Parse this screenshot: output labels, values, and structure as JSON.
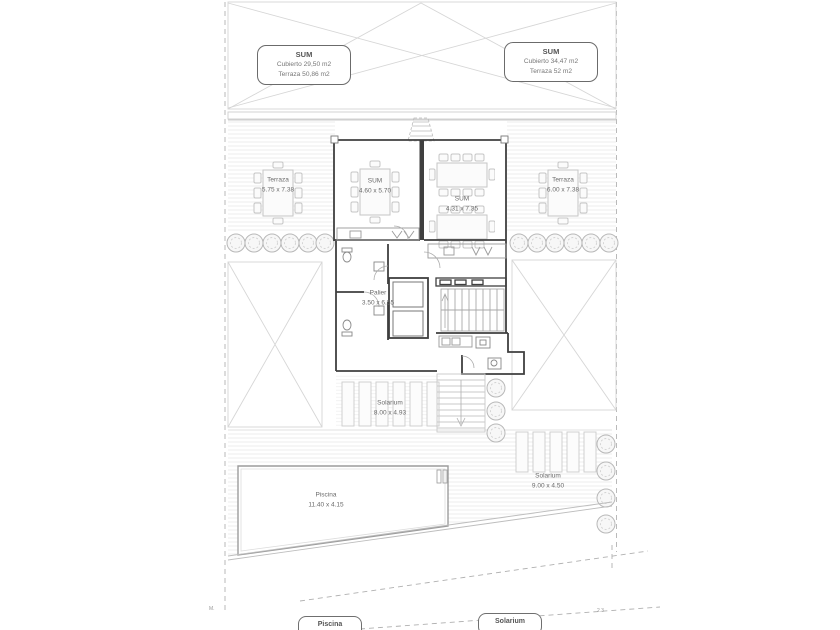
{
  "plan": {
    "callouts": {
      "left": {
        "title": "SUM",
        "line1": "Cubierto 29,50 m2",
        "line2": "Terraza 50,86 m2"
      },
      "right": {
        "title": "SUM",
        "line1": "Cubierto 34,47 m2",
        "line2": "Terraza 52 m2"
      }
    },
    "rooms": {
      "terraza_left": {
        "name": "Terraza",
        "dims": "5.75 x 7.38"
      },
      "sum_left": {
        "name": "SUM",
        "dims": "4.60 x 5.70"
      },
      "sum_right": {
        "name": "SUM",
        "dims": "4.31 x 7.35"
      },
      "terraza_right": {
        "name": "Terraza",
        "dims": "6.00 x 7.38"
      },
      "palier": {
        "name": "Palier",
        "dims": "3.50 x 6.55"
      },
      "solarium_center": {
        "name": "Solarium",
        "dims": "8.00 x 4.93"
      },
      "piscina": {
        "name": "Piscina",
        "dims": "11.40 x 4.15"
      },
      "solarium_right": {
        "name": "Solarium",
        "dims": "9.00 x 4.50"
      }
    },
    "bottom_tags": {
      "piscina": "Piscina",
      "solarium": "Solarium"
    },
    "edge_marks": {
      "left": "M.",
      "right": "2.3"
    },
    "colors": {
      "wall": "#3f3f3f",
      "line_light": "#d0d0d0",
      "line_mid": "#9a9a9a",
      "text": "#6a6a6a"
    }
  }
}
